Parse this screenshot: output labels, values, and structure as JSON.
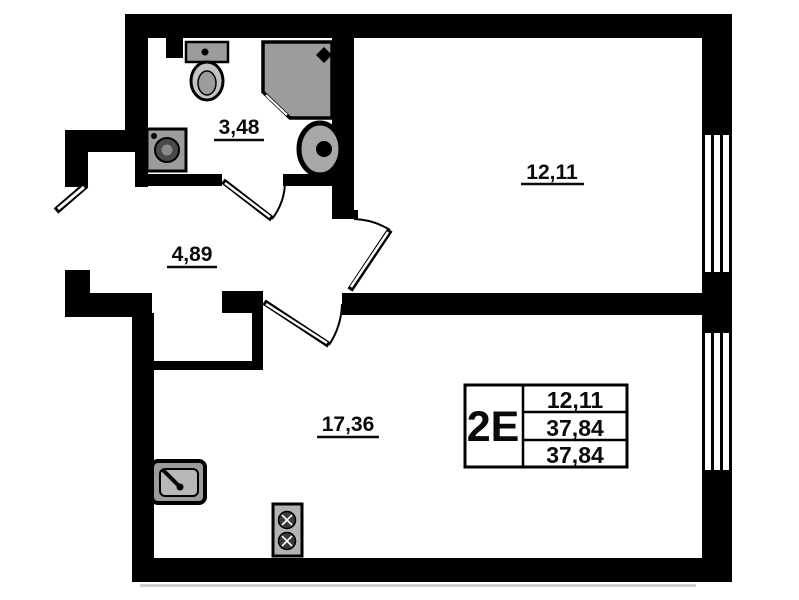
{
  "rooms": [
    {
      "id": "bathroom",
      "area_label": "3,48"
    },
    {
      "id": "hallway",
      "area_label": "4,89"
    },
    {
      "id": "room",
      "area_label": "12,11"
    },
    {
      "id": "kitchen-living-room",
      "area_label": "17,36"
    }
  ],
  "info_box": {
    "unit_code": "2E",
    "areas": [
      "12,11",
      "37,84",
      "37,84"
    ]
  },
  "fixtures": [
    "toilet-icon",
    "shower-cabin-icon",
    "washbasin-icon",
    "washing-machine-icon",
    "kitchen-sink-icon",
    "stove-icon"
  ],
  "colors": {
    "walls": "#000000",
    "fixture_fill": "#9c9c9c",
    "background": "#ffffff"
  }
}
